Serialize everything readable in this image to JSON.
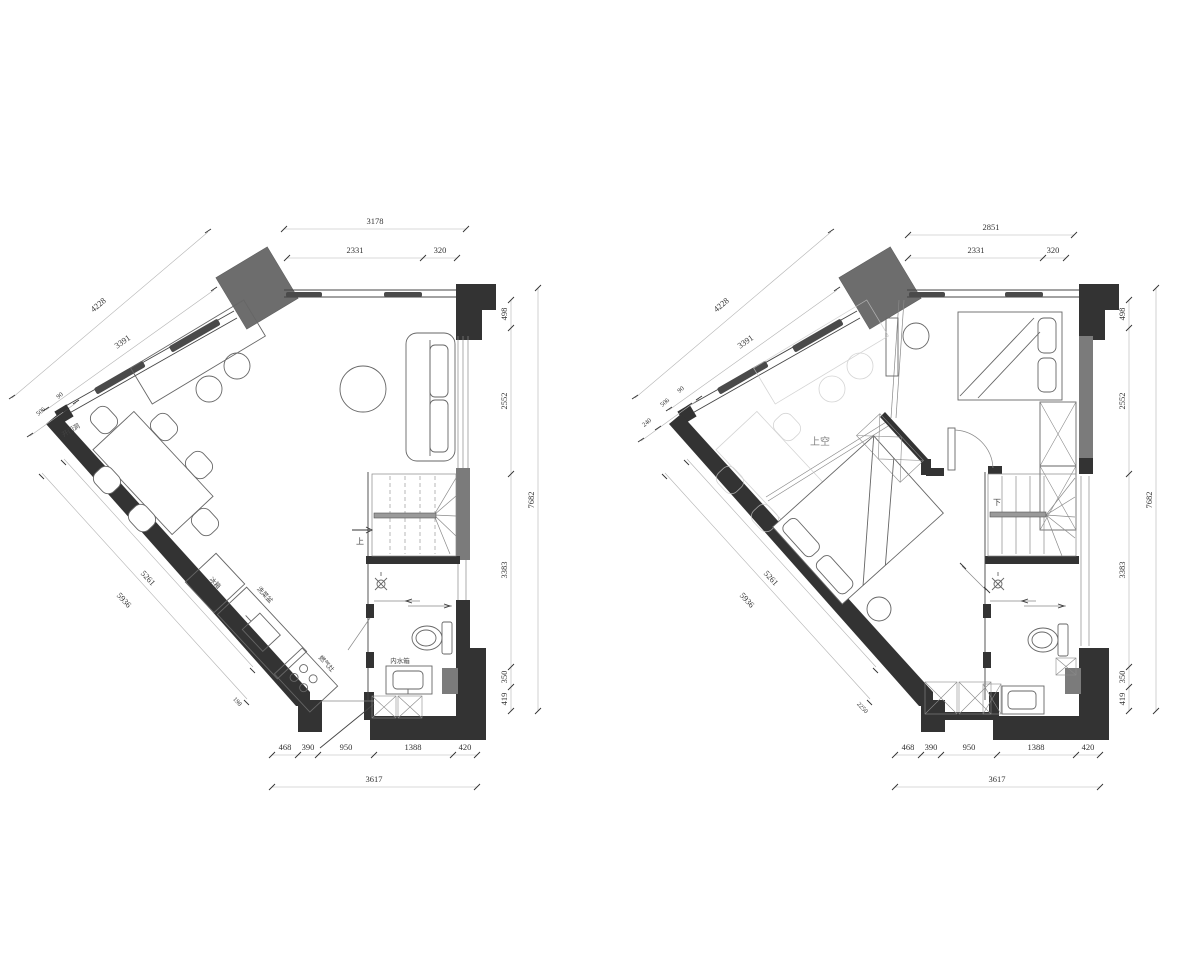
{
  "document": {
    "type": "architectural floor plan drawing",
    "sheets": 2
  },
  "colors": {
    "wall": "#333333",
    "column": "#6d6d6d",
    "wall_gray": "#7b7b7b",
    "window_hatch": "#4a4a4a",
    "dim_line": "#b3b3b3",
    "dim_text": "#333333",
    "ghost_line": "#c6c6c6",
    "background": "#ffffff"
  },
  "plans": [
    {
      "name": "lower-floor-plan",
      "top": {
        "total": "3178",
        "part1": "2331",
        "part2": "320"
      },
      "left_upper": {
        "outer": "4228",
        "inner": "3391",
        "s1": "506",
        "s2": "90"
      },
      "left_lower": {
        "outer": "5936",
        "inner": "5261",
        "end": "198"
      },
      "right": {
        "total": "7682",
        "p1": "498",
        "p2": "2552",
        "p3": "3383",
        "p4": "350",
        "p5": "419"
      },
      "bottom": {
        "total": "3617",
        "p1": "468",
        "p2": "390",
        "p3": "950",
        "p4": "1388",
        "p5": "420"
      },
      "labels": {
        "door_opening": "开门洞",
        "stair": "上",
        "fridge": "冰箱",
        "sink": "洗菜盆",
        "stove": "燃气灶",
        "cistern": "内水箱"
      }
    },
    {
      "name": "upper-floor-plan",
      "top": {
        "total": "2851",
        "part1": "2331",
        "part2": "320"
      },
      "left_upper": {
        "outer": "4228",
        "inner": "3391",
        "s0": "240",
        "s1": "506",
        "s2": "90"
      },
      "left_lower": {
        "outer": "5936",
        "inner": "5261",
        "end": "2250"
      },
      "right": {
        "total": "7682",
        "p1": "498",
        "p2": "2552",
        "p3": "3383",
        "p4": "350",
        "p5": "419"
      },
      "bottom": {
        "total": "3617",
        "p1": "468",
        "p2": "390",
        "p3": "950",
        "p4": "1388",
        "p5": "420"
      },
      "labels": {
        "void": "上空",
        "stair": "下"
      }
    }
  ]
}
